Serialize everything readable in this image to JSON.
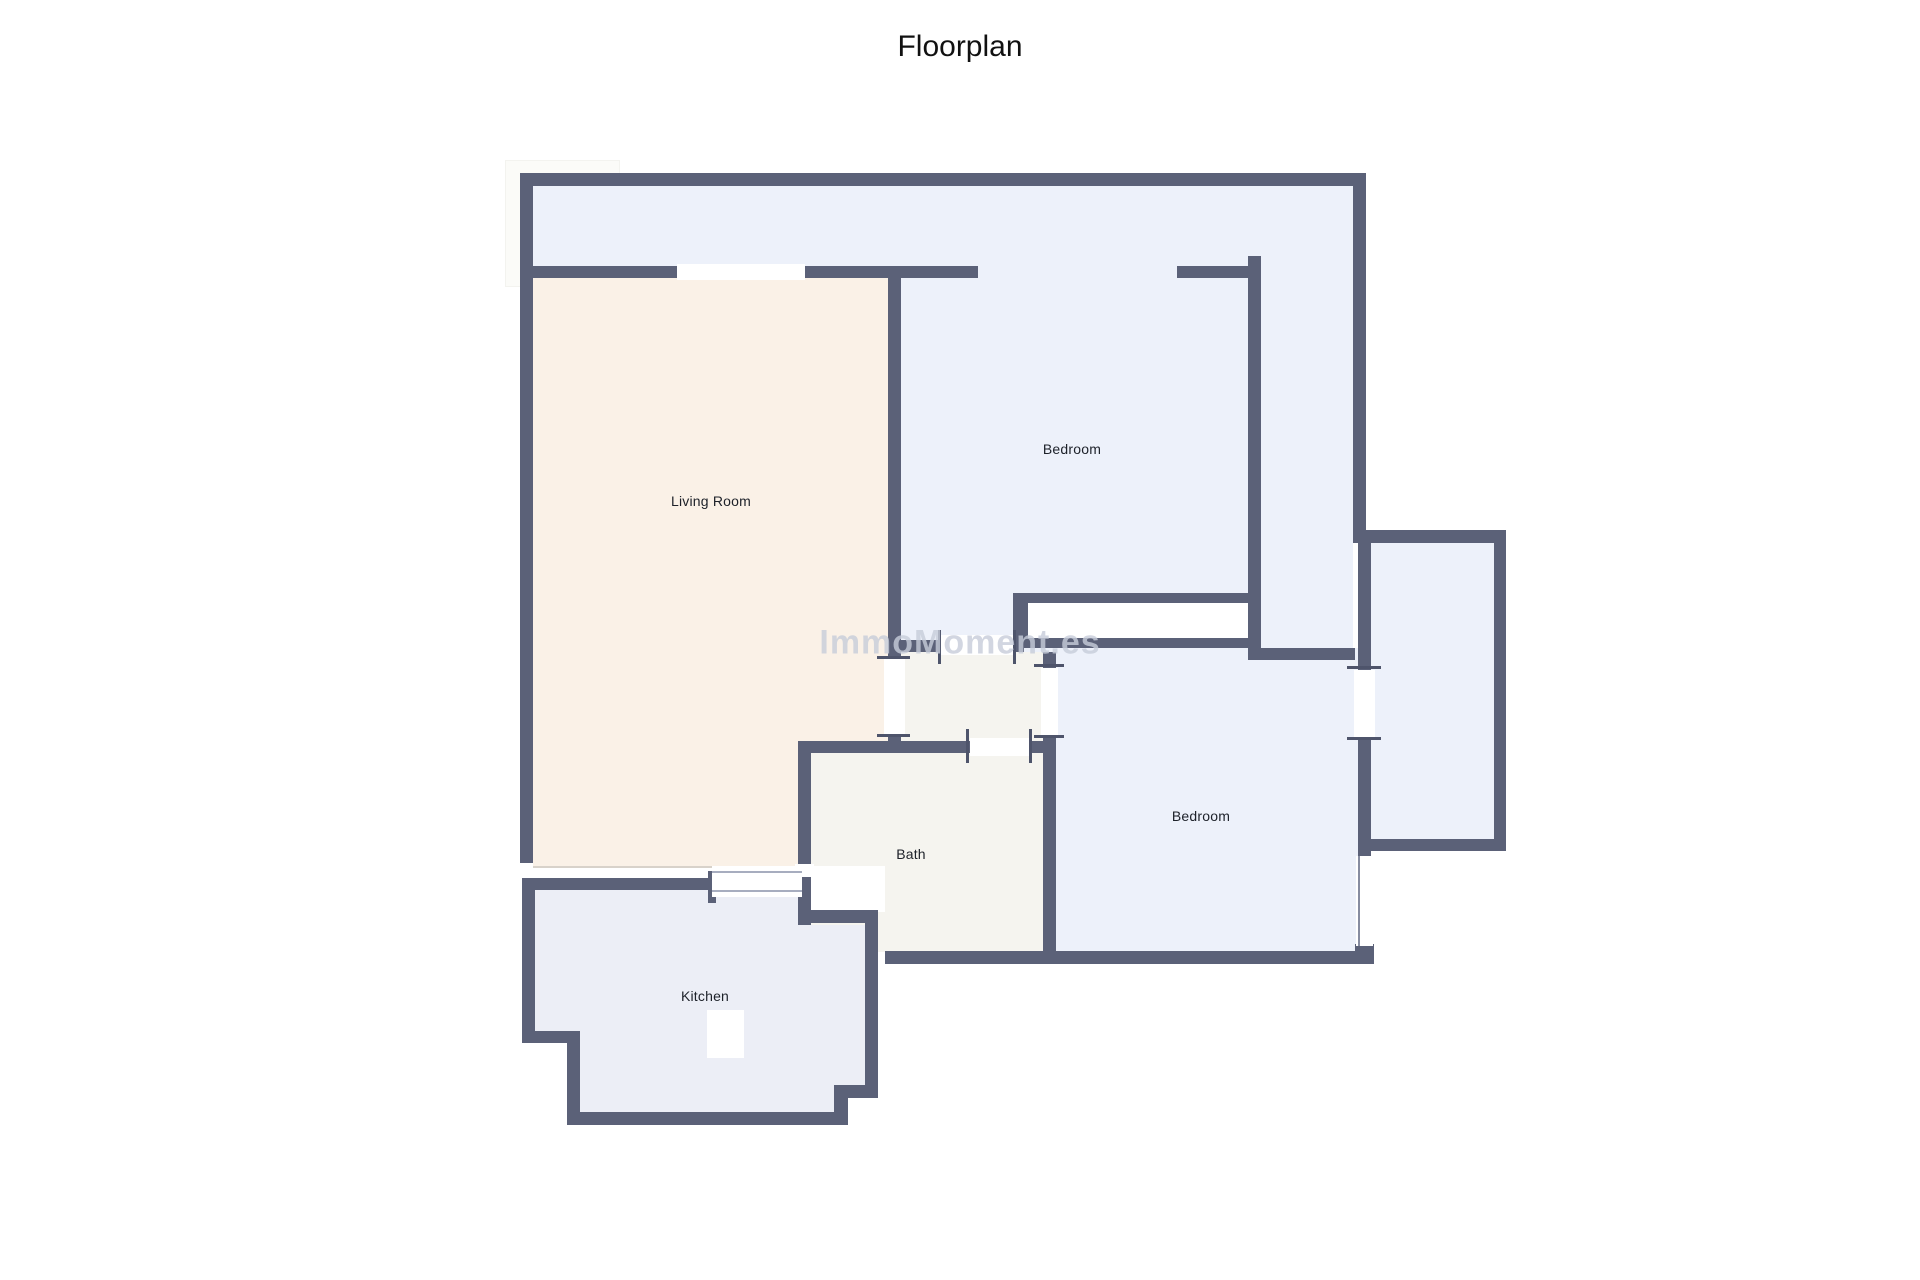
{
  "title": "Floorplan",
  "watermark": "ImmoMoment.es",
  "rooms": {
    "living_room": {
      "label": "Living Room"
    },
    "bedroom_upper": {
      "label": "Bedroom"
    },
    "bedroom_lower": {
      "label": "Bedroom"
    },
    "bath": {
      "label": "Bath"
    },
    "kitchen": {
      "label": "Kitchen"
    }
  },
  "colors": {
    "wall": "#5b6178",
    "living_room_floor": "#faf1e7",
    "bedroom_floor": "#edf1fa",
    "bath_floor": "#f5f4ef",
    "kitchen_floor": "#eceef6",
    "watermark": "#c7cdda",
    "label_text": "#1d2129",
    "title_text": "#111111"
  }
}
